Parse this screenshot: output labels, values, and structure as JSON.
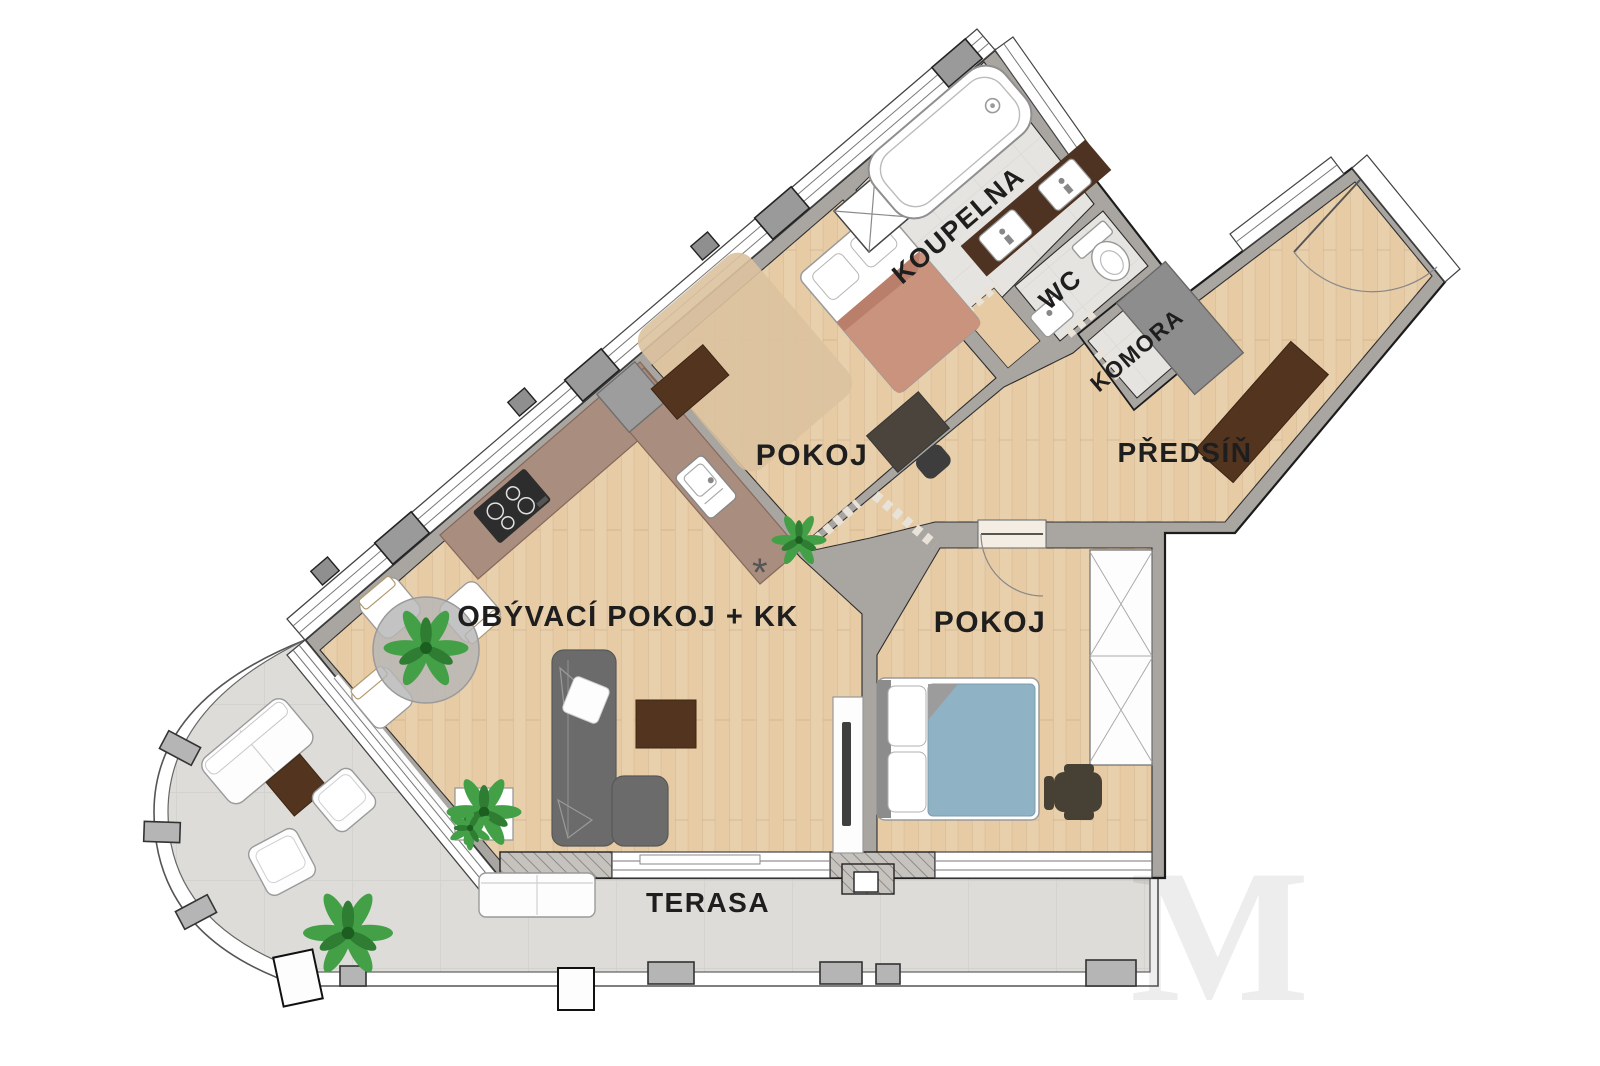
{
  "plan": {
    "type": "apartment-floor-plan",
    "rooms": {
      "koupelna": {
        "label": "KOUPELNA"
      },
      "wc": {
        "label": "WC"
      },
      "komora": {
        "label": "KOMORA"
      },
      "predsin": {
        "label": "PŘEDSÍŇ"
      },
      "pokoj1": {
        "label": "POKOJ"
      },
      "pokoj2": {
        "label": "POKOJ"
      },
      "obyvaci": {
        "label": "OBÝVACÍ POKOJ + KK"
      },
      "terasa": {
        "label": "TERASA"
      }
    },
    "symbols": {
      "kitchen_vent": "*"
    },
    "watermark": "M",
    "colors": {
      "wall": "#a9a6a2",
      "wall_dark": "#8f8f8f",
      "wood": "#e7cba4",
      "tile": "#e6e4e0",
      "terrace": "#dedcd8",
      "counter": "#a98d7f",
      "vanity": "#4e3222",
      "furniture_dark_brown": "#53351f",
      "sofa": "#6b6b6b",
      "bed_blue": "#8fb2c4",
      "blanket": "#c9937e",
      "rug": "#dbc29e",
      "plant": "#43a047"
    }
  }
}
